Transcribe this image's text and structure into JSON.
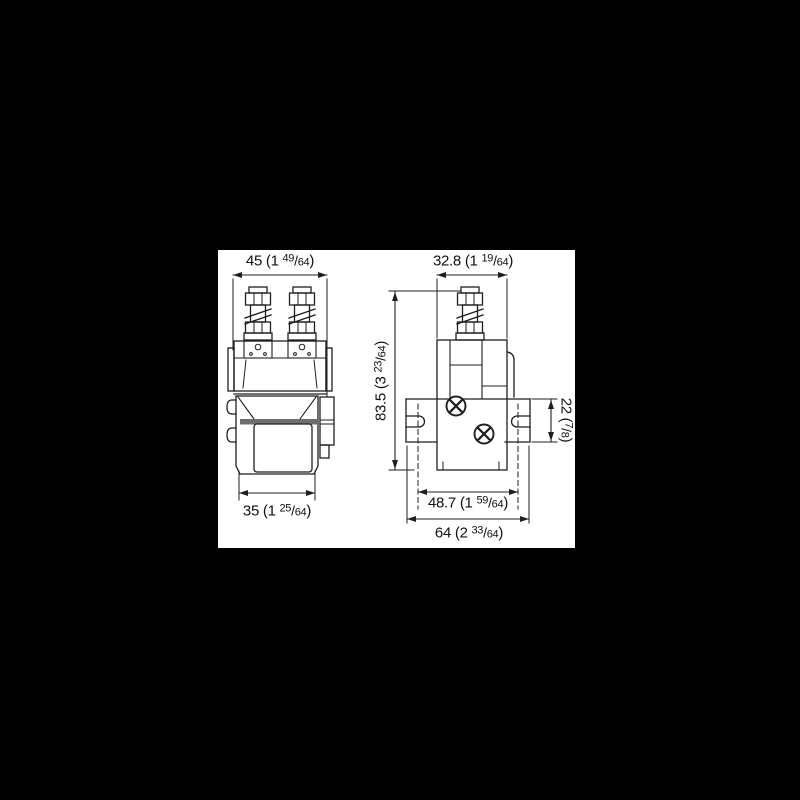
{
  "scene": {
    "background": "#000000",
    "panel_background": "#ffffff",
    "line_color": "#1f1f1f",
    "shade_color": "#6e6e6e"
  },
  "dimensions": {
    "front_width_top": {
      "label": "45 (1 49/64)",
      "parts": [
        "45 (1 ",
        "49",
        "/",
        "64",
        ")"
      ]
    },
    "side_width_top": {
      "label": "32.8 (1 19/64)",
      "parts": [
        "32.8 (1 ",
        "19",
        "/",
        "64",
        ")"
      ]
    },
    "overall_height": {
      "label": "83.5 (3 23/64)",
      "parts": [
        "83.5 (3 ",
        "23",
        "/",
        "64",
        ")"
      ]
    },
    "bracket_height": {
      "label": "22 (7/8)",
      "parts": [
        "22 (",
        "7",
        "/",
        "8",
        ")"
      ]
    },
    "front_width_bottom": {
      "label": "35 (1 25/64)",
      "parts": [
        "35 (1 ",
        "25",
        "/",
        "64",
        ")"
      ]
    },
    "hole_spacing": {
      "label": "48.7 (1 59/64)",
      "parts": [
        "48.7 (1 ",
        "59",
        "/",
        "64",
        ")"
      ]
    },
    "bracket_width": {
      "label": "64 (2 33/64)",
      "parts": [
        "64 (2 ",
        "33",
        "/",
        "64",
        ")"
      ]
    }
  }
}
